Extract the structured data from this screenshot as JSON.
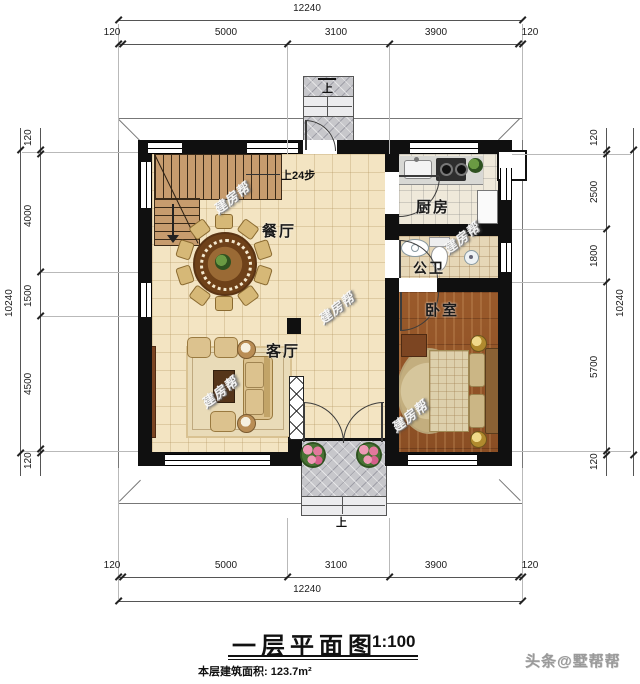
{
  "title": {
    "name": "一层平面图",
    "scale": "1:100",
    "area": "本层建筑面积: 123.7m²"
  },
  "brand": {
    "toutiao": "头条@墅帮帮",
    "watermark": "建房帮"
  },
  "rooms": {
    "dining": "餐厅",
    "kitchen": "厨房",
    "bath": "公卫",
    "bedroom": "卧室",
    "living": "客厅"
  },
  "labels": {
    "stair_note": "上24步",
    "up_top": "上",
    "up_bottom": "上"
  },
  "dims": {
    "top": {
      "total": "12240",
      "segs": [
        "120",
        "5000",
        "3100",
        "3900",
        "120"
      ]
    },
    "bottom": {
      "total": "12240",
      "segs": [
        "120",
        "5000",
        "3100",
        "3900",
        "120"
      ]
    },
    "left": {
      "total": "10240",
      "segs": [
        "120",
        "4000",
        "1500",
        "4500",
        "120"
      ]
    },
    "right": {
      "total": "10240",
      "segs": [
        "120",
        "2500",
        "1800",
        "5700",
        "120"
      ]
    }
  },
  "colors": {
    "wall": "#101010",
    "floor_tile": "#f3e4c2",
    "wood": "#94552a",
    "porch": "#c7c7cb",
    "stair": "#c79c6e"
  }
}
